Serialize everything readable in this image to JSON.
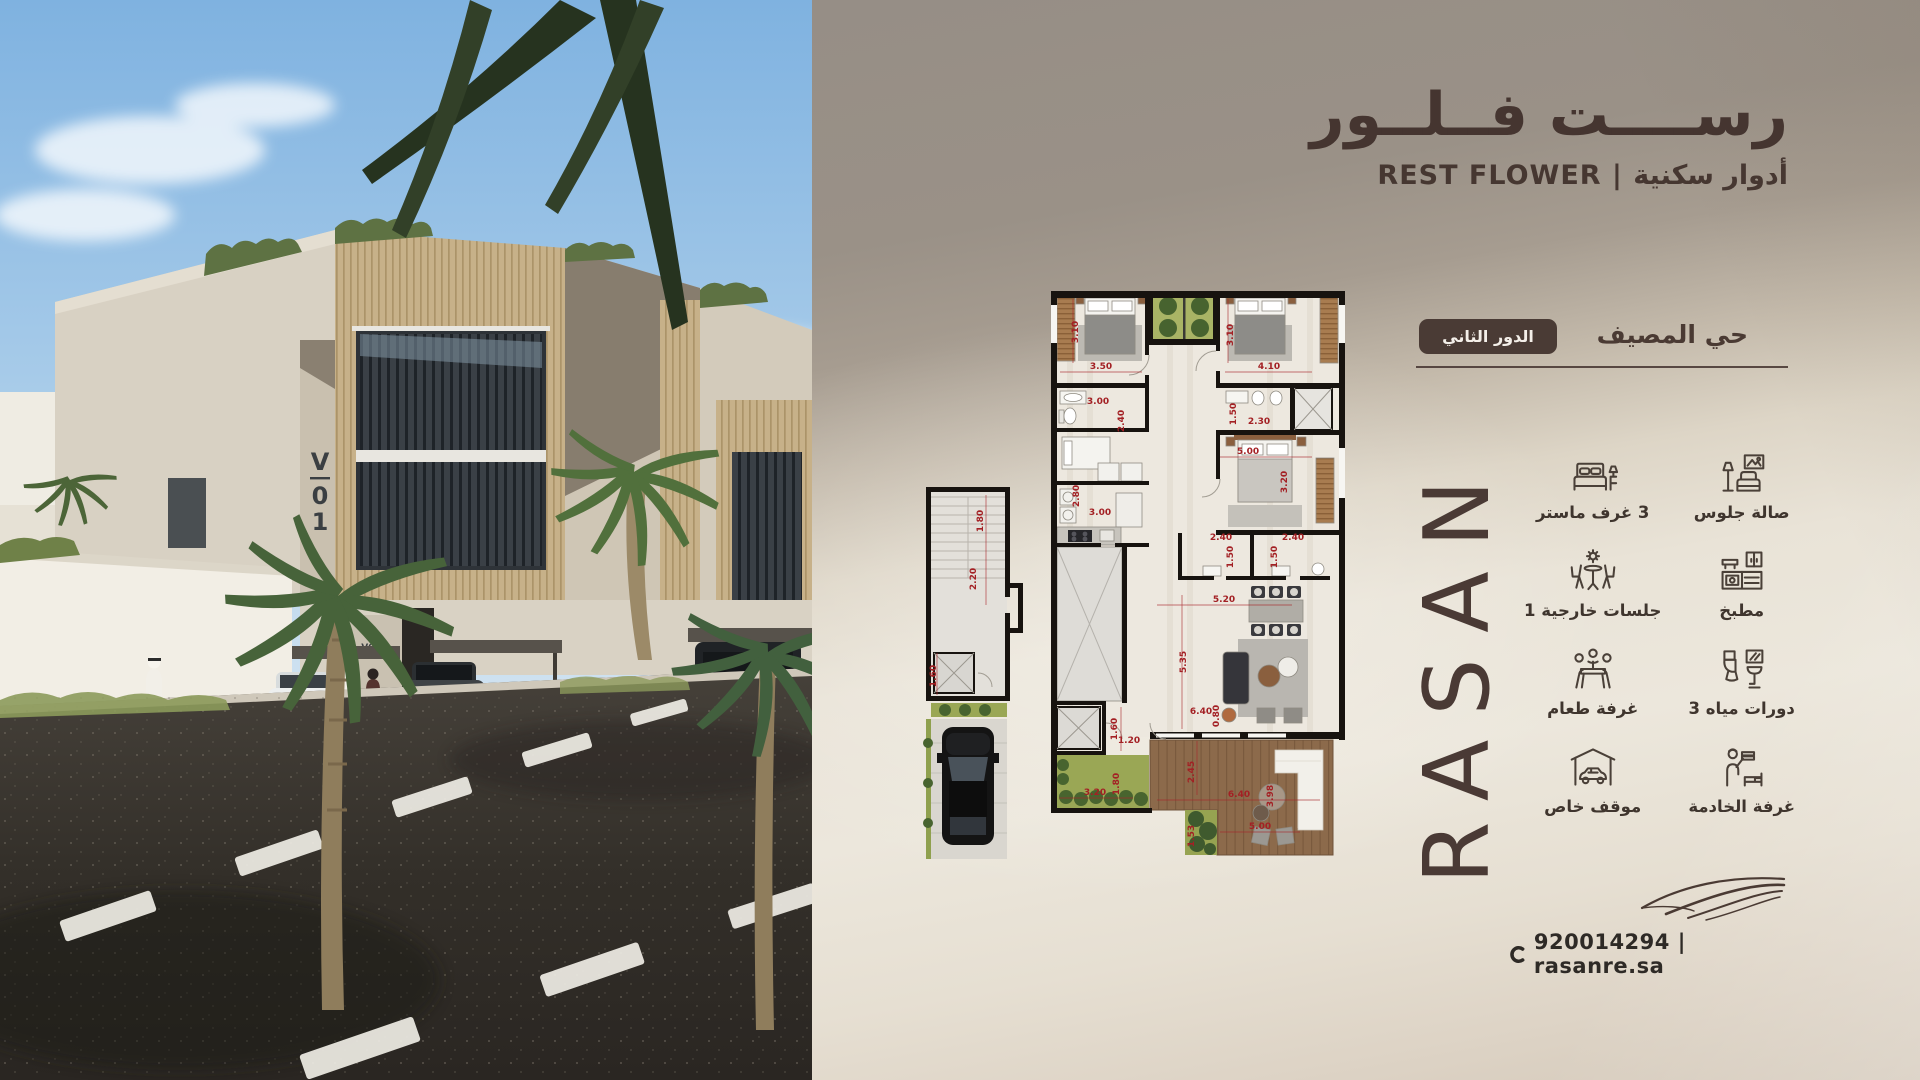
{
  "poster": {
    "title_ar": "رســــت فــلــور",
    "subtitle": "REST FLOWER | أدوار سكنية",
    "district": "حي المصيف",
    "floor_badge": "الدور الثاني",
    "brand": "RASAN",
    "contact": "920014294 | rasanre.sa",
    "features": [
      {
        "icon": "bed-icon",
        "label": "3 غرف ماستر"
      },
      {
        "icon": "sofa-icon",
        "label": "صالة جلوس"
      },
      {
        "icon": "outdoor-seating-icon",
        "label": "جلسات خارجية 1"
      },
      {
        "icon": "kitchen-icon",
        "label": "مطبخ"
      },
      {
        "icon": "dining-icon",
        "label": "غرفة طعام"
      },
      {
        "icon": "bathroom-icon",
        "label": "دورات مياه 3"
      },
      {
        "icon": "carport-icon",
        "label": "موقف خاص"
      },
      {
        "icon": "maid-room-icon",
        "label": "غرفة الخادمة"
      }
    ]
  },
  "photo": {
    "building_sign": "V01",
    "sign_chars": [
      "V",
      "0",
      "1"
    ],
    "entrance_sign": "V02"
  },
  "floor_plan": {
    "dimensions": [
      {
        "v": "3.10",
        "x": 158,
        "y": 49,
        "r": -90
      },
      {
        "v": "3.50",
        "x": 181,
        "y": 86,
        "r": 0
      },
      {
        "v": "3.10",
        "x": 313,
        "y": 52,
        "r": -90
      },
      {
        "v": "4.10",
        "x": 349,
        "y": 86,
        "r": 0
      },
      {
        "v": "3.00",
        "x": 178,
        "y": 121,
        "r": 0
      },
      {
        "v": "2.40",
        "x": 204,
        "y": 138,
        "r": -90
      },
      {
        "v": "1.50",
        "x": 316,
        "y": 131,
        "r": -90
      },
      {
        "v": "2.30",
        "x": 339,
        "y": 141,
        "r": 0
      },
      {
        "v": "5.00",
        "x": 328,
        "y": 171,
        "r": 0
      },
      {
        "v": "3.20",
        "x": 367,
        "y": 199,
        "r": -90
      },
      {
        "v": "2.80",
        "x": 159,
        "y": 213,
        "r": -90
      },
      {
        "v": "3.00",
        "x": 180,
        "y": 232,
        "r": 0
      },
      {
        "v": "2.40",
        "x": 301,
        "y": 257,
        "r": 0
      },
      {
        "v": "1.50",
        "x": 313,
        "y": 274,
        "r": -90
      },
      {
        "v": "2.40",
        "x": 373,
        "y": 257,
        "r": 0
      },
      {
        "v": "1.50",
        "x": 357,
        "y": 274,
        "r": -90
      },
      {
        "v": "5.20",
        "x": 304,
        "y": 319,
        "r": 0
      },
      {
        "v": "5.35",
        "x": 266,
        "y": 379,
        "r": -90
      },
      {
        "v": "0.80",
        "x": 299,
        "y": 433,
        "r": -90
      },
      {
        "v": "6.40",
        "x": 281,
        "y": 431,
        "r": 0
      },
      {
        "v": "1.60",
        "x": 197,
        "y": 446,
        "r": -90
      },
      {
        "v": "1.20",
        "x": 209,
        "y": 460,
        "r": 0
      },
      {
        "v": "1.80",
        "x": 199,
        "y": 501,
        "r": -90
      },
      {
        "v": "3.20",
        "x": 175,
        "y": 512,
        "r": 0
      },
      {
        "v": "2.45",
        "x": 274,
        "y": 489,
        "r": -90
      },
      {
        "v": "6.40",
        "x": 319,
        "y": 514,
        "r": 0
      },
      {
        "v": "3.98",
        "x": 353,
        "y": 513,
        "r": -90
      },
      {
        "v": "5.00",
        "x": 340,
        "y": 546,
        "r": 0
      },
      {
        "v": "1.53",
        "x": 274,
        "y": 553,
        "r": -90
      },
      {
        "v": "1.80",
        "x": 63,
        "y": 238,
        "r": -90
      },
      {
        "v": "2.20",
        "x": 56,
        "y": 296,
        "r": -90
      },
      {
        "v": "1.60",
        "x": 16,
        "y": 393,
        "r": -90
      }
    ]
  },
  "colors": {
    "brand_brown": "#4A3A35",
    "badge_bg": "#4A3B35",
    "dimension_red": "#A32024",
    "panel_top": "#97908A",
    "panel_light": "#EAE4D9"
  }
}
